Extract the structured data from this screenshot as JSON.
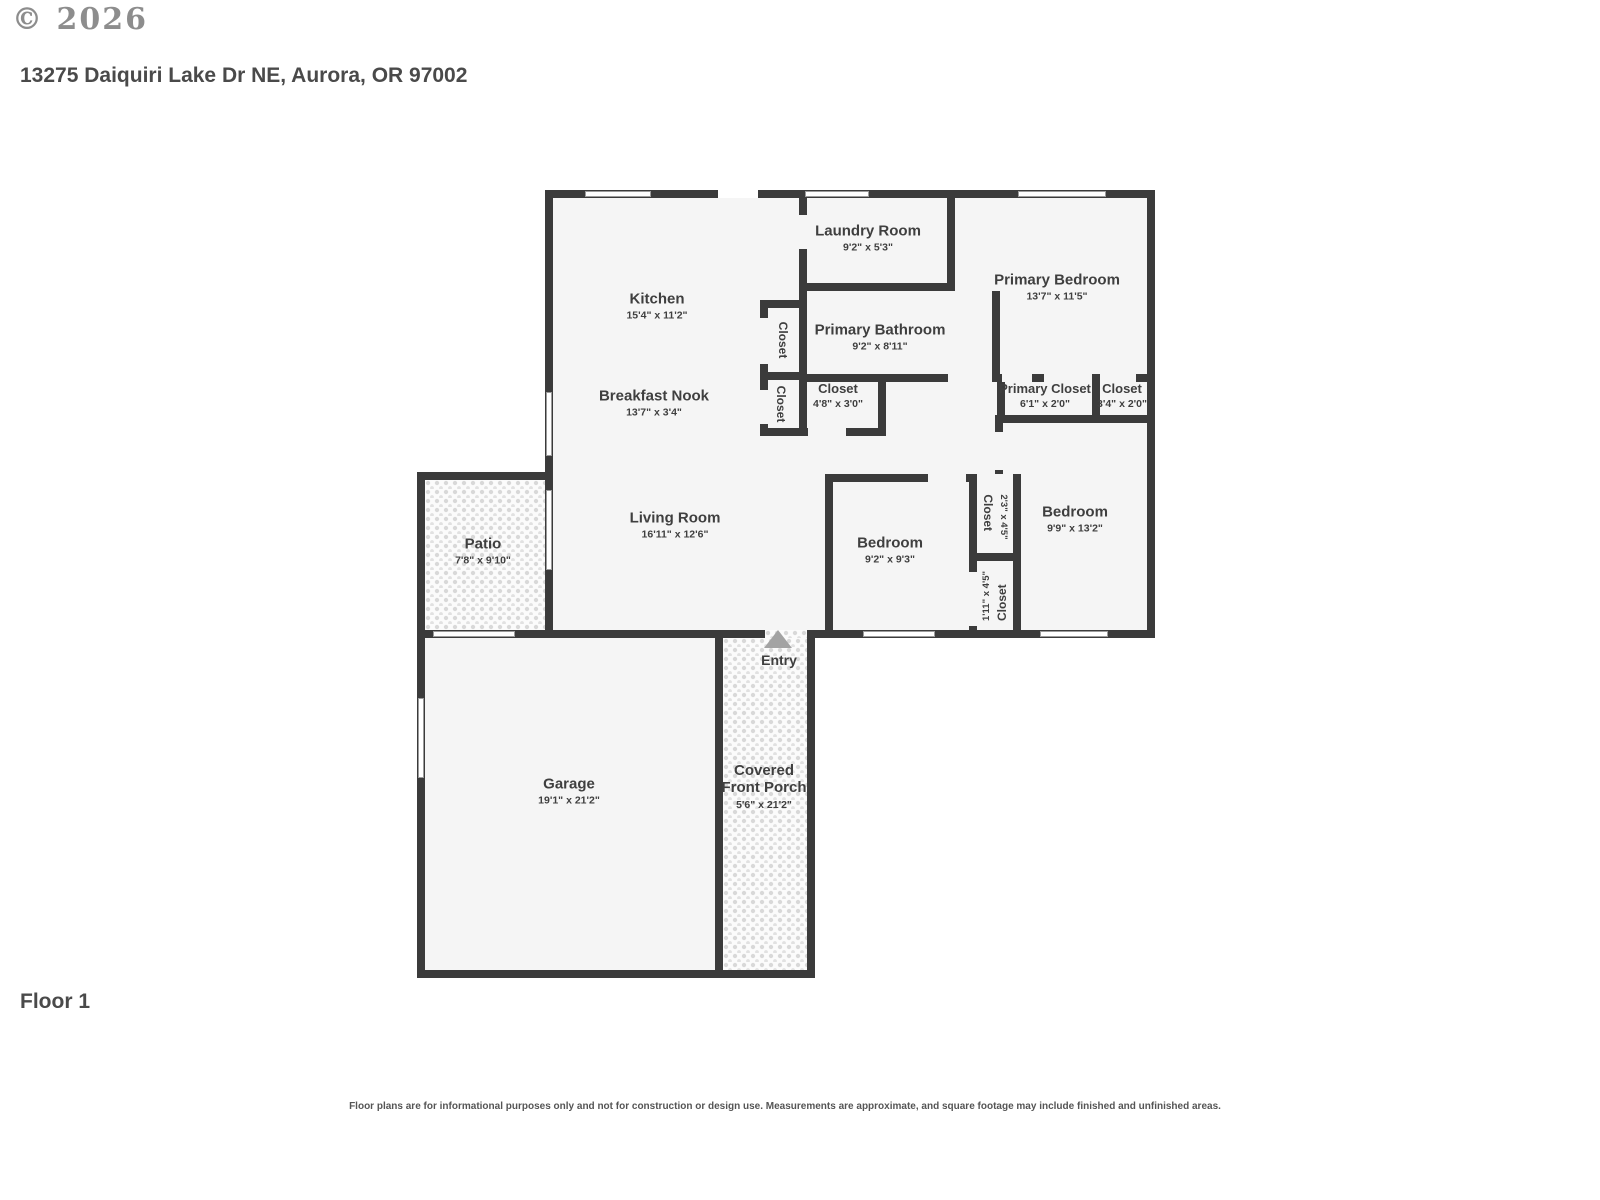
{
  "header": {
    "copyright": "© 2026",
    "address": "13275 Daiquiri Lake Dr NE, Aurora, OR 97002"
  },
  "footer": {
    "floor_label": "Floor 1",
    "disclaimer": "Floor plans are for informational purposes only and not for construction or design use. Measurements are approximate, and square footage may include finished and unfinished areas."
  },
  "colors": {
    "wall": "#3b3b3b",
    "floor": "#f5f5f5",
    "text": "#3f3f3f",
    "entry_arrow": "#a3a3a3"
  },
  "rooms": {
    "kitchen": {
      "name": "Kitchen",
      "dims": "15'4\" x 11'2\""
    },
    "laundry": {
      "name": "Laundry Room",
      "dims": "9'2\" x 5'3\""
    },
    "primary_bedroom": {
      "name": "Primary Bedroom",
      "dims": "13'7\" x 11'5\""
    },
    "primary_bathroom": {
      "name": "Primary Bathroom",
      "dims": "9'2\" x 8'11\""
    },
    "closet_hall_upper": {
      "name": "Closet"
    },
    "closet_hall_lower": {
      "name": "Closet"
    },
    "closet_hall": {
      "name": "Closet",
      "dims": "4'8\" x 3'0\""
    },
    "primary_closet": {
      "name": "Primary Closet",
      "dims": "6'1\" x 2'0\""
    },
    "closet_small": {
      "name": "Closet",
      "dims": "3'4\" x 2'0\""
    },
    "breakfast_nook": {
      "name": "Breakfast Nook",
      "dims": "13'7\" x 3'4\""
    },
    "living_room": {
      "name": "Living Room",
      "dims": "16'11\" x 12'6\""
    },
    "bedroom_mid": {
      "name": "Bedroom",
      "dims": "9'2\" x 9'3\""
    },
    "closet_23": {
      "name": "Closet",
      "dims": "2'3\" x 4'5\""
    },
    "bedroom_right": {
      "name": "Bedroom",
      "dims": "9'9\" x 13'2\""
    },
    "closet_111": {
      "name": "Closet",
      "dims": "1'11\" x 4'5\""
    },
    "patio": {
      "name": "Patio",
      "dims": "7'8\" x 9'10\""
    },
    "entry": {
      "name": "Entry"
    },
    "garage": {
      "name": "Garage",
      "dims": "19'1\" x 21'2\""
    },
    "porch": {
      "name": "Covered Front Porch",
      "dims": "5'6\" x 21'2\""
    }
  }
}
